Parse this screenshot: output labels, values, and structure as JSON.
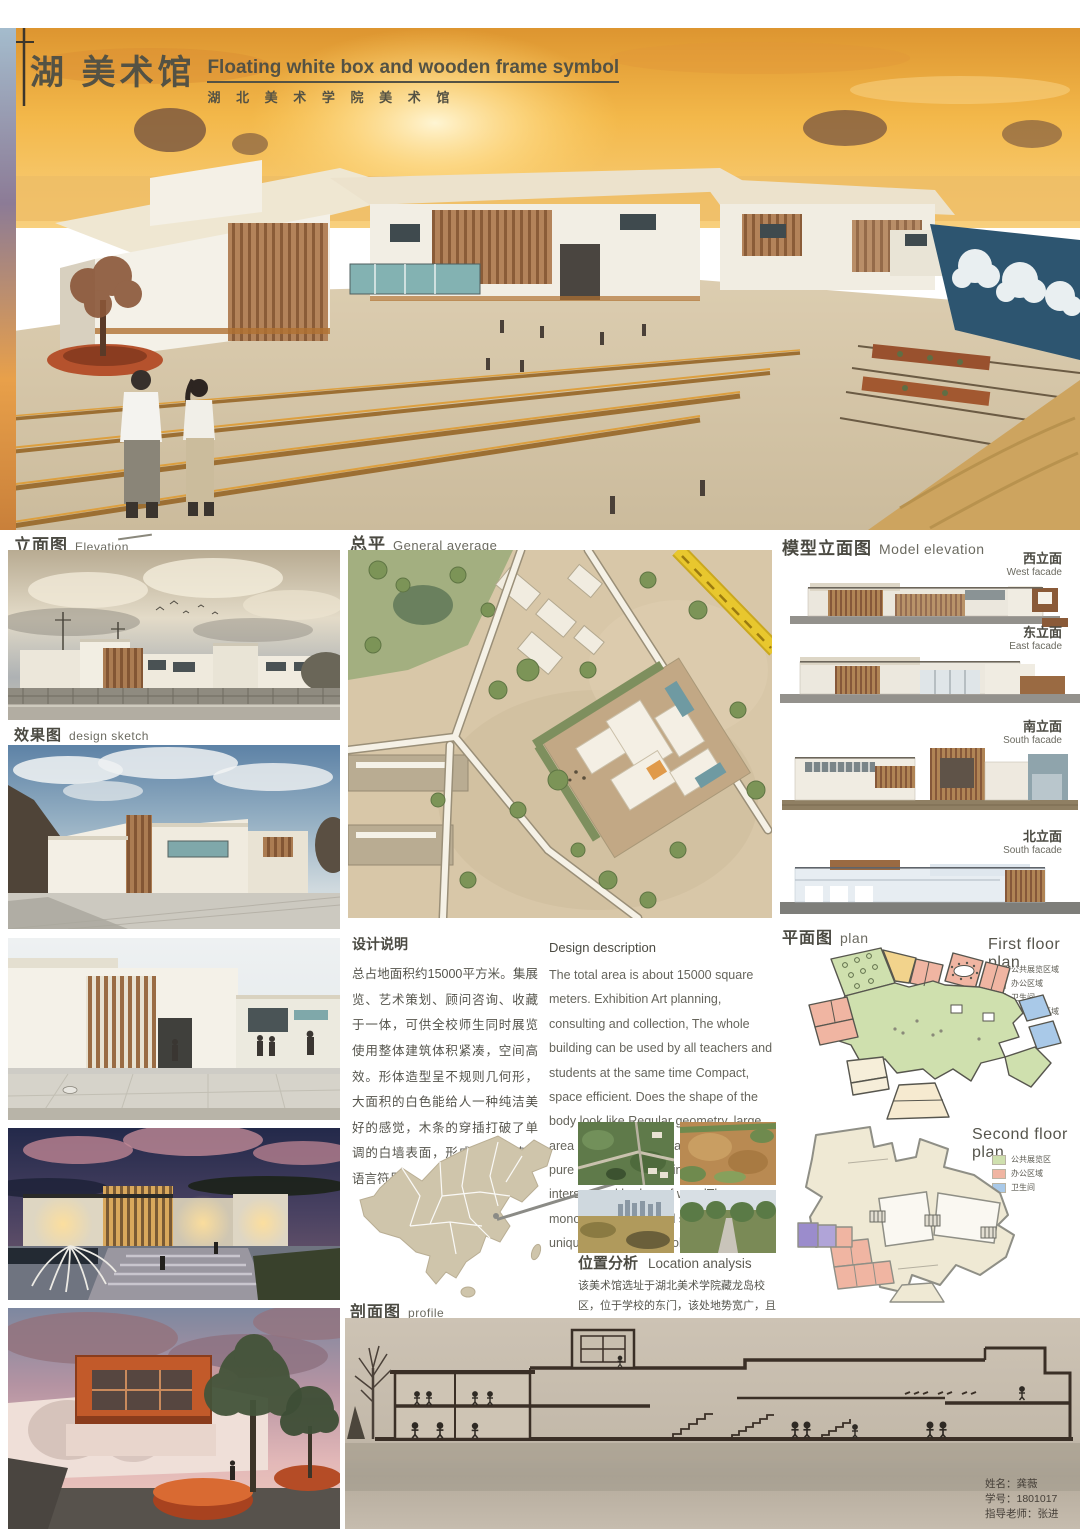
{
  "header": {
    "title_cn": "湖  美术馆",
    "subtitle_en": "Floating white box and wooden frame symbol",
    "subtitle_cn": "湖 北 美 术 学 院 美 术 馆"
  },
  "labels": {
    "elevation_cn": "立面图",
    "elevation_en": "Elevation",
    "sketch_cn": "效果图",
    "sketch_en": "design sketch",
    "siteplan_cn": "总平",
    "siteplan_en": "General average",
    "model_cn": "模型立面图",
    "model_en": "Model elevation",
    "plan_cn": "平面图",
    "plan_en": "plan",
    "profile_cn": "剖面图",
    "profile_en": "profile"
  },
  "facades": [
    {
      "cn": "西立面",
      "en": "West facade"
    },
    {
      "cn": "东立面",
      "en": "East facade"
    },
    {
      "cn": "南立面",
      "en": "South facade"
    },
    {
      "cn": "北立面",
      "en": "South facade"
    }
  ],
  "design_description": {
    "title_cn": "设计说明",
    "body_cn": "总占地面积约15000平方米。集展览、艺术策划、顾问咨询、收藏于一体，可供全校师生同时展览使用整体建筑体积紧凑，空间高效。形体造型呈不规则几何形，大面积的白色能给人一种纯洁美好的感觉，木条的穿插打破了单调的白墙表面，形成一种独特的语言符号。",
    "title_en": "Design description",
    "body_en": "The total area is about 15000 square meters. Exhibition Art planning, consulting and collection, The whole building can be used by all teachers and students at the same time  Compact, space efficient. Does the shape of the body look like Regular geometry, large area of white can give a personA kind of pure and beautiful feeling, the interspersed broken of woodThe monotonous white wall surface forms a unique  anguage symbols."
  },
  "location": {
    "title_cn": "位置分析",
    "title_en": "Location analysis",
    "body_cn": "该美术馆选址于湖北美术学院藏龙岛校区，位于学校的东门，该处地势宽广，且接大门，方便建设和参观。"
  },
  "floor_plans": {
    "first": {
      "title": "First floor plan",
      "legend": [
        {
          "label": "公共展览区域",
          "color": "#cfe0ae"
        },
        {
          "label": "办公区域",
          "color": "#f0b5a2"
        },
        {
          "label": "卫生间",
          "color": "#a9c9e8"
        },
        {
          "label": "休闲消费区域",
          "color": "#f6eccb"
        }
      ]
    },
    "second": {
      "title": "Second floor plan",
      "legend": [
        {
          "label": "公共展览区",
          "color": "#cfe0ae"
        },
        {
          "label": "办公区域",
          "color": "#f0b5a2"
        },
        {
          "label": "卫生间",
          "color": "#a9c9e8"
        }
      ]
    }
  },
  "credits": {
    "name": "姓名：龚薇",
    "student_id": "学号：1801017",
    "advisor": "指导老师：张进"
  },
  "colors": {
    "accent_wood": "#a9714b",
    "title_text": "#545244",
    "sunset_sky": "#f2a93b",
    "plan_green": "#cfe0ae",
    "plan_pink": "#f0b5a2",
    "plan_blue": "#a9c9e8"
  }
}
